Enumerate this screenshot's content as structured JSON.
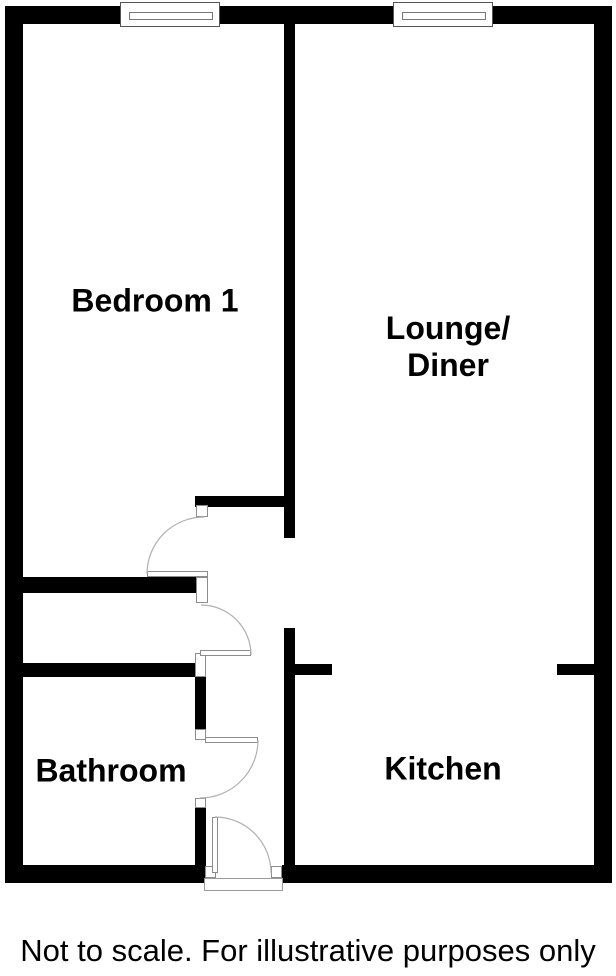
{
  "caption": "Not to scale. For illustrative purposes only",
  "colors": {
    "wall": "#000000",
    "background": "#ffffff",
    "door_arc": "#b0b0b0",
    "frame_border": "#8c8c8c"
  },
  "rooms": [
    {
      "name": "bedroom-1",
      "lines": [
        "Bedroom 1"
      ],
      "cx": 155,
      "cy": 301
    },
    {
      "name": "lounge-diner",
      "lines": [
        "Lounge/",
        "Diner"
      ],
      "cx": 448,
      "cy": 347
    },
    {
      "name": "bathroom",
      "lines": [
        "Bathroom"
      ],
      "cx": 111,
      "cy": 771
    },
    {
      "name": "kitchen",
      "lines": [
        "Kitchen"
      ],
      "cx": 443,
      "cy": 769
    }
  ],
  "walls": [
    {
      "name": "top-wall",
      "x": 5,
      "y": 6,
      "w": 607,
      "h": 18
    },
    {
      "name": "left-wall",
      "x": 5,
      "y": 6,
      "w": 18,
      "h": 877
    },
    {
      "name": "right-wall",
      "x": 594,
      "y": 6,
      "w": 18,
      "h": 877
    },
    {
      "name": "bottom-wall-left",
      "x": 5,
      "y": 865,
      "w": 200,
      "h": 18
    },
    {
      "name": "bottom-wall-right",
      "x": 282,
      "y": 865,
      "w": 330,
      "h": 18
    },
    {
      "name": "central-wall-upper",
      "x": 284,
      "y": 24,
      "w": 11,
      "h": 514
    },
    {
      "name": "bedroom-south-wall",
      "x": 195,
      "y": 496,
      "w": 100,
      "h": 11
    },
    {
      "name": "cupboard-north-wall",
      "x": 23,
      "y": 577,
      "w": 173,
      "h": 16
    },
    {
      "name": "bathroom-north-wall",
      "x": 23,
      "y": 663,
      "w": 172,
      "h": 14
    },
    {
      "name": "central-wall-lower",
      "x": 284,
      "y": 628,
      "w": 11,
      "h": 237
    },
    {
      "name": "kitchen-stub-left",
      "x": 295,
      "y": 664,
      "w": 37,
      "h": 11
    },
    {
      "name": "kitchen-stub-right",
      "x": 557,
      "y": 664,
      "w": 37,
      "h": 11
    },
    {
      "name": "bathroom-east-wall-upper",
      "x": 195,
      "y": 677,
      "w": 11,
      "h": 52
    },
    {
      "name": "bathroom-east-wall-lower",
      "x": 195,
      "y": 808,
      "w": 11,
      "h": 59
    }
  ],
  "jambs": [
    {
      "name": "bedroom-door-jamb-top",
      "x": 196,
      "y": 505,
      "w": 12,
      "h": 12
    },
    {
      "name": "bedroom-door-jamb-bottom",
      "x": 196,
      "y": 577,
      "w": 12,
      "h": 26
    },
    {
      "name": "cupboard-door-jamb-bottom",
      "x": 195,
      "y": 653,
      "w": 11,
      "h": 24
    },
    {
      "name": "bathroom-door-jamb-top",
      "x": 195,
      "y": 729,
      "w": 11,
      "h": 11
    },
    {
      "name": "bathroom-door-jamb-bottom",
      "x": 195,
      "y": 798,
      "w": 11,
      "h": 10
    },
    {
      "name": "entrance-jamb-left",
      "x": 205,
      "y": 866,
      "w": 11,
      "h": 12
    },
    {
      "name": "entrance-jamb-right",
      "x": 271,
      "y": 866,
      "w": 11,
      "h": 12
    }
  ],
  "door_leaves": [
    {
      "name": "bedroom-door-leaf",
      "x": 147,
      "y": 571,
      "w": 61,
      "h": 6
    },
    {
      "name": "cupboard-door-leaf",
      "x": 200,
      "y": 650,
      "w": 51,
      "h": 6
    },
    {
      "name": "bathroom-door-leaf",
      "x": 205,
      "y": 737,
      "w": 53,
      "h": 6
    },
    {
      "name": "entrance-door-leaf",
      "x": 212,
      "y": 817,
      "w": 6,
      "h": 56
    }
  ],
  "door_arcs": [
    {
      "name": "bedroom-door-swing-arc",
      "d": "M 204 517 A 57 57 0 0 0 147 574"
    },
    {
      "name": "cupboard-door-swing-arc",
      "d": "M 251 655 A 50 50 0 0 0 201 605"
    },
    {
      "name": "bathroom-door-swing-arc",
      "d": "M 258 740 A 58 58 0 0 1 200 798"
    },
    {
      "name": "entrance-door-swing-arc",
      "d": "M 215 817 A 56 56 0 0 1 271 873"
    }
  ],
  "windows": [
    {
      "name": "bedroom-window",
      "x": 120,
      "y": 2,
      "w": 100,
      "h": 25,
      "glazing": {
        "x": 8,
        "y": 9,
        "w": 84,
        "h": 8
      }
    },
    {
      "name": "lounge-window",
      "x": 393,
      "y": 2,
      "w": 100,
      "h": 25,
      "glazing": {
        "x": 8,
        "y": 9,
        "w": 84,
        "h": 8
      }
    }
  ],
  "threshold": {
    "name": "entrance-threshold",
    "x": 204,
    "y": 878,
    "w": 79,
    "h": 13
  }
}
